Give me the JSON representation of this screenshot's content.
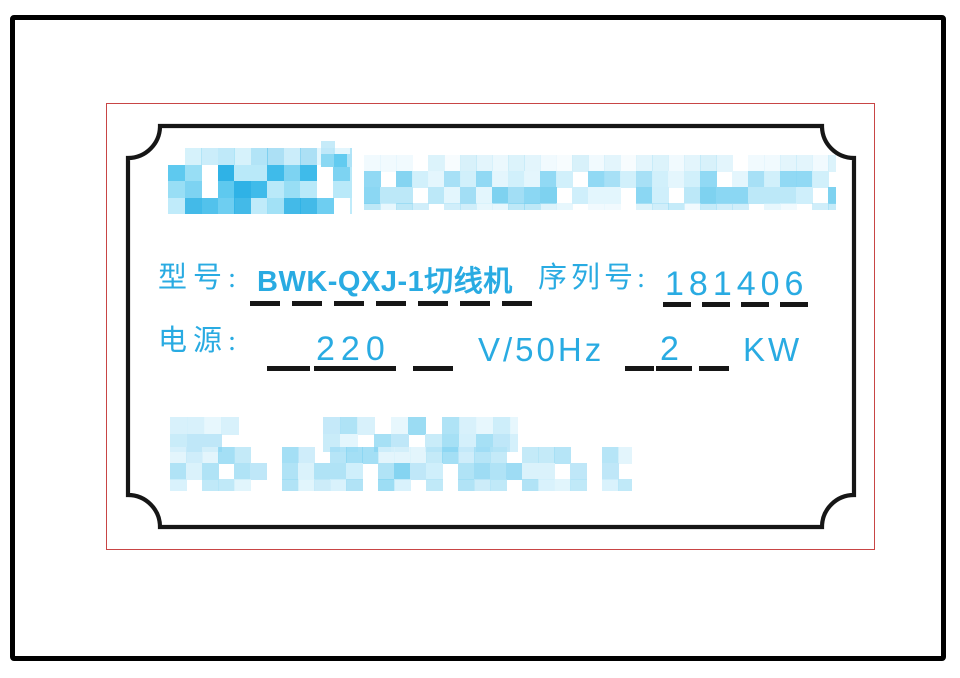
{
  "nameplate": {
    "model_label": "型号:",
    "model_value": "BWK-QXJ-1切线机",
    "serial_label": "序列号:",
    "serial_value": "181406",
    "power_label": "电源:",
    "power_voltage": "220",
    "power_freq_unit": "V/50Hz",
    "power_kw_value": "2",
    "power_kw_unit": "KW"
  },
  "colors": {
    "accent_blue": "#29abe2",
    "ink_black": "#161616",
    "crop_mark_red": "#c84545",
    "background": "#ffffff"
  },
  "redactions": [
    {
      "name": "brand-logo",
      "x": 168,
      "y": 148,
      "w": 184,
      "h": 66,
      "block": 16.5,
      "rows": 4,
      "row_alpha": [
        0.4,
        1,
        1,
        0.9
      ],
      "white_chance": 0.15,
      "seed": 7,
      "palette": [
        "#3fbbea",
        "#5ec9ef",
        "#7dd3f2",
        "#2fb2e6",
        "#98def5",
        "#b9e9f9"
      ]
    },
    {
      "name": "brand-mark",
      "x": 321,
      "y": 141,
      "w": 31,
      "h": 26,
      "block": 13,
      "rows": 2,
      "row_alpha": [
        0.7,
        1
      ],
      "white_chance": 0.3,
      "seed": 5,
      "palette": [
        "#62cbf0",
        "#8ad8f3",
        "#aee3f7"
      ]
    },
    {
      "name": "title-band",
      "x": 364,
      "y": 155,
      "w": 472,
      "h": 55,
      "block": 16,
      "rows": 4,
      "row_alpha": [
        0.3,
        0.95,
        1,
        0.5
      ],
      "white_chance": 0.12,
      "seed": 11,
      "palette": [
        "#a2def5",
        "#bce8f8",
        "#8bd7f3",
        "#cfeffb",
        "#7ed2f0",
        "#e3f6fd"
      ]
    },
    {
      "name": "footer-line-1",
      "x": 170,
      "y": 417,
      "w": 348,
      "h": 36,
      "block": 17,
      "rows": 2,
      "row_alpha": [
        0.9,
        1
      ],
      "white_chance": 0.22,
      "seed": 21,
      "gaps": [
        [
          243,
          281
        ]
      ],
      "palette": [
        "#bfe7f8",
        "#a6e0f5",
        "#d4f0fb",
        "#90d8f2",
        "#c9ecf9",
        "#e4f6fd"
      ]
    },
    {
      "name": "footer-line-2",
      "x": 170,
      "y": 447,
      "w": 462,
      "h": 44,
      "block": 16,
      "rows": 3,
      "row_alpha": [
        0.75,
        1,
        0.8
      ],
      "white_chance": 0.2,
      "seed": 33,
      "gaps": [
        [
          243,
          281
        ]
      ],
      "palette": [
        "#bfe7f8",
        "#9edcf4",
        "#cfeffb",
        "#85d4f1",
        "#daf2fb",
        "#b0e3f6"
      ]
    }
  ]
}
